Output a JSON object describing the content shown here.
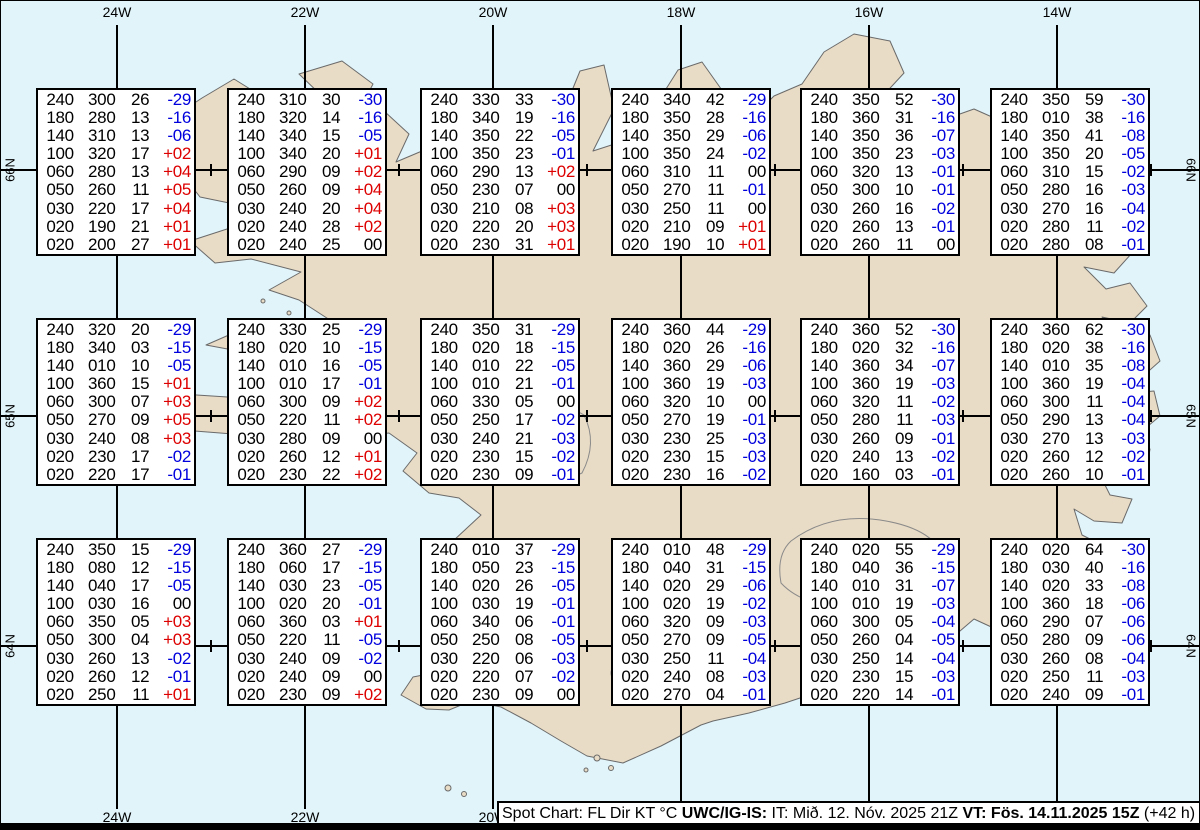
{
  "title": "Spot Chart Iceland UWC/IG-IS",
  "colors": {
    "ocean": "#e1f4fa",
    "land": "#e9dcc6",
    "coastline": "#6a6a6a",
    "grid": "#000000",
    "temp_negative": "#0000dd",
    "temp_positive": "#dd0000",
    "temp_zero": "#000000",
    "box_background": "#ffffff"
  },
  "axis": {
    "top": [
      "24W",
      "22W",
      "20W",
      "18W",
      "16W",
      "14W"
    ],
    "bottom": [
      "24W",
      "22W",
      "20W"
    ],
    "left": [
      "66N",
      "65N",
      "64N"
    ],
    "right": [
      "66N",
      "65N",
      "64N"
    ]
  },
  "caption": {
    "segments": [
      {
        "text": "Spot Chart: FL Dir KT °C ",
        "bold": false
      },
      {
        "text": "UWC/IG-IS:",
        "bold": true
      },
      {
        "text": " IT: Mið. 12. Nóv. 2025 21Z ",
        "bold": false
      },
      {
        "text": "VT: Fös. 14.11.2025 15Z",
        "bold": true
      },
      {
        "text": " (+42 h)",
        "bold": false
      }
    ]
  },
  "chart_data": {
    "type": "table",
    "columns": [
      "FL",
      "Dir",
      "KT",
      "°C"
    ],
    "grid": {
      "rows": 3,
      "cols": 6
    },
    "boxes": [
      {
        "rows": [
          [
            "240",
            "300",
            "26",
            "-29"
          ],
          [
            "180",
            "280",
            "13",
            "-16"
          ],
          [
            "140",
            "310",
            "13",
            "-06"
          ],
          [
            "100",
            "320",
            "17",
            "+02"
          ],
          [
            "060",
            "280",
            "13",
            "+04"
          ],
          [
            "050",
            "260",
            "11",
            "+05"
          ],
          [
            "030",
            "220",
            "17",
            "+04"
          ],
          [
            "020",
            "190",
            "21",
            "+01"
          ],
          [
            "020",
            "200",
            "27",
            "+01"
          ]
        ]
      },
      {
        "rows": [
          [
            "240",
            "310",
            "30",
            "-30"
          ],
          [
            "180",
            "320",
            "14",
            "-16"
          ],
          [
            "140",
            "340",
            "15",
            "-05"
          ],
          [
            "100",
            "340",
            "20",
            "+01"
          ],
          [
            "060",
            "290",
            "09",
            "+02"
          ],
          [
            "050",
            "260",
            "09",
            "+04"
          ],
          [
            "030",
            "240",
            "20",
            "+04"
          ],
          [
            "020",
            "240",
            "28",
            "+02"
          ],
          [
            "020",
            "240",
            "25",
            "00"
          ]
        ]
      },
      {
        "rows": [
          [
            "240",
            "330",
            "33",
            "-30"
          ],
          [
            "180",
            "340",
            "19",
            "-16"
          ],
          [
            "140",
            "350",
            "22",
            "-05"
          ],
          [
            "100",
            "350",
            "23",
            "-01"
          ],
          [
            "060",
            "290",
            "13",
            "+02"
          ],
          [
            "050",
            "230",
            "07",
            "00"
          ],
          [
            "030",
            "210",
            "08",
            "+03"
          ],
          [
            "020",
            "220",
            "20",
            "+03"
          ],
          [
            "020",
            "230",
            "31",
            "+01"
          ]
        ]
      },
      {
        "rows": [
          [
            "240",
            "340",
            "42",
            "-29"
          ],
          [
            "180",
            "350",
            "28",
            "-16"
          ],
          [
            "140",
            "350",
            "29",
            "-06"
          ],
          [
            "100",
            "350",
            "24",
            "-02"
          ],
          [
            "060",
            "310",
            "11",
            "00"
          ],
          [
            "050",
            "270",
            "11",
            "-01"
          ],
          [
            "030",
            "250",
            "11",
            "00"
          ],
          [
            "020",
            "210",
            "09",
            "+01"
          ],
          [
            "020",
            "190",
            "10",
            "+01"
          ]
        ]
      },
      {
        "rows": [
          [
            "240",
            "350",
            "52",
            "-30"
          ],
          [
            "180",
            "360",
            "31",
            "-16"
          ],
          [
            "140",
            "350",
            "36",
            "-07"
          ],
          [
            "100",
            "350",
            "23",
            "-03"
          ],
          [
            "060",
            "320",
            "13",
            "-01"
          ],
          [
            "050",
            "300",
            "10",
            "-01"
          ],
          [
            "030",
            "260",
            "16",
            "-02"
          ],
          [
            "020",
            "260",
            "13",
            "-01"
          ],
          [
            "020",
            "260",
            "11",
            "00"
          ]
        ]
      },
      {
        "rows": [
          [
            "240",
            "350",
            "59",
            "-30"
          ],
          [
            "180",
            "010",
            "38",
            "-16"
          ],
          [
            "140",
            "350",
            "41",
            "-08"
          ],
          [
            "100",
            "350",
            "20",
            "-05"
          ],
          [
            "060",
            "310",
            "15",
            "-02"
          ],
          [
            "050",
            "280",
            "16",
            "-03"
          ],
          [
            "030",
            "270",
            "16",
            "-04"
          ],
          [
            "020",
            "280",
            "11",
            "-02"
          ],
          [
            "020",
            "280",
            "08",
            "-01"
          ]
        ]
      },
      {
        "rows": [
          [
            "240",
            "320",
            "20",
            "-29"
          ],
          [
            "180",
            "340",
            "03",
            "-15"
          ],
          [
            "140",
            "010",
            "10",
            "-05"
          ],
          [
            "100",
            "360",
            "15",
            "+01"
          ],
          [
            "060",
            "300",
            "07",
            "+03"
          ],
          [
            "050",
            "270",
            "09",
            "+05"
          ],
          [
            "030",
            "240",
            "08",
            "+03"
          ],
          [
            "020",
            "230",
            "17",
            "-02"
          ],
          [
            "020",
            "220",
            "17",
            "-01"
          ]
        ]
      },
      {
        "rows": [
          [
            "240",
            "330",
            "25",
            "-29"
          ],
          [
            "180",
            "020",
            "10",
            "-15"
          ],
          [
            "140",
            "010",
            "16",
            "-05"
          ],
          [
            "100",
            "010",
            "17",
            "-01"
          ],
          [
            "060",
            "300",
            "09",
            "+02"
          ],
          [
            "050",
            "220",
            "11",
            "+02"
          ],
          [
            "030",
            "280",
            "09",
            "00"
          ],
          [
            "020",
            "260",
            "12",
            "+01"
          ],
          [
            "020",
            "230",
            "22",
            "+02"
          ]
        ]
      },
      {
        "rows": [
          [
            "240",
            "350",
            "31",
            "-29"
          ],
          [
            "180",
            "020",
            "18",
            "-15"
          ],
          [
            "140",
            "010",
            "22",
            "-05"
          ],
          [
            "100",
            "010",
            "21",
            "-01"
          ],
          [
            "060",
            "330",
            "05",
            "00"
          ],
          [
            "050",
            "250",
            "17",
            "-02"
          ],
          [
            "030",
            "240",
            "21",
            "-03"
          ],
          [
            "020",
            "230",
            "15",
            "-02"
          ],
          [
            "020",
            "230",
            "09",
            "-01"
          ]
        ]
      },
      {
        "rows": [
          [
            "240",
            "360",
            "44",
            "-29"
          ],
          [
            "180",
            "020",
            "26",
            "-16"
          ],
          [
            "140",
            "360",
            "29",
            "-06"
          ],
          [
            "100",
            "360",
            "19",
            "-03"
          ],
          [
            "060",
            "320",
            "10",
            "00"
          ],
          [
            "050",
            "270",
            "19",
            "-01"
          ],
          [
            "030",
            "230",
            "25",
            "-03"
          ],
          [
            "020",
            "230",
            "15",
            "-03"
          ],
          [
            "020",
            "230",
            "16",
            "-02"
          ]
        ]
      },
      {
        "rows": [
          [
            "240",
            "360",
            "52",
            "-30"
          ],
          [
            "180",
            "020",
            "32",
            "-16"
          ],
          [
            "140",
            "360",
            "34",
            "-07"
          ],
          [
            "100",
            "360",
            "19",
            "-03"
          ],
          [
            "060",
            "320",
            "11",
            "-02"
          ],
          [
            "050",
            "280",
            "11",
            "-03"
          ],
          [
            "030",
            "260",
            "09",
            "-01"
          ],
          [
            "020",
            "240",
            "13",
            "-02"
          ],
          [
            "020",
            "160",
            "03",
            "-01"
          ]
        ]
      },
      {
        "rows": [
          [
            "240",
            "360",
            "62",
            "-30"
          ],
          [
            "180",
            "020",
            "38",
            "-16"
          ],
          [
            "140",
            "010",
            "35",
            "-08"
          ],
          [
            "100",
            "360",
            "19",
            "-04"
          ],
          [
            "060",
            "300",
            "11",
            "-04"
          ],
          [
            "050",
            "290",
            "13",
            "-04"
          ],
          [
            "030",
            "270",
            "13",
            "-03"
          ],
          [
            "020",
            "260",
            "12",
            "-02"
          ],
          [
            "020",
            "260",
            "10",
            "-01"
          ]
        ]
      },
      {
        "rows": [
          [
            "240",
            "350",
            "15",
            "-29"
          ],
          [
            "180",
            "080",
            "12",
            "-15"
          ],
          [
            "140",
            "040",
            "17",
            "-05"
          ],
          [
            "100",
            "030",
            "16",
            "00"
          ],
          [
            "060",
            "350",
            "05",
            "+03"
          ],
          [
            "050",
            "300",
            "04",
            "+03"
          ],
          [
            "030",
            "260",
            "13",
            "-02"
          ],
          [
            "020",
            "260",
            "12",
            "-01"
          ],
          [
            "020",
            "250",
            "11",
            "+01"
          ]
        ]
      },
      {
        "rows": [
          [
            "240",
            "360",
            "27",
            "-29"
          ],
          [
            "180",
            "060",
            "17",
            "-15"
          ],
          [
            "140",
            "030",
            "23",
            "-05"
          ],
          [
            "100",
            "020",
            "20",
            "-01"
          ],
          [
            "060",
            "360",
            "03",
            "+01"
          ],
          [
            "050",
            "220",
            "11",
            "-05"
          ],
          [
            "030",
            "240",
            "09",
            "-02"
          ],
          [
            "020",
            "240",
            "09",
            "00"
          ],
          [
            "020",
            "230",
            "09",
            "+02"
          ]
        ]
      },
      {
        "rows": [
          [
            "240",
            "010",
            "37",
            "-29"
          ],
          [
            "180",
            "050",
            "23",
            "-15"
          ],
          [
            "140",
            "020",
            "26",
            "-05"
          ],
          [
            "100",
            "030",
            "19",
            "-01"
          ],
          [
            "060",
            "340",
            "06",
            "-01"
          ],
          [
            "050",
            "250",
            "08",
            "-05"
          ],
          [
            "030",
            "220",
            "06",
            "-03"
          ],
          [
            "020",
            "220",
            "07",
            "-02"
          ],
          [
            "020",
            "230",
            "09",
            "00"
          ]
        ]
      },
      {
        "rows": [
          [
            "240",
            "010",
            "48",
            "-29"
          ],
          [
            "180",
            "040",
            "31",
            "-15"
          ],
          [
            "140",
            "020",
            "29",
            "-06"
          ],
          [
            "100",
            "020",
            "19",
            "-02"
          ],
          [
            "060",
            "320",
            "09",
            "-03"
          ],
          [
            "050",
            "270",
            "09",
            "-05"
          ],
          [
            "030",
            "250",
            "11",
            "-04"
          ],
          [
            "020",
            "240",
            "08",
            "-03"
          ],
          [
            "020",
            "270",
            "04",
            "-01"
          ]
        ]
      },
      {
        "rows": [
          [
            "240",
            "020",
            "55",
            "-29"
          ],
          [
            "180",
            "040",
            "36",
            "-15"
          ],
          [
            "140",
            "010",
            "31",
            "-07"
          ],
          [
            "100",
            "010",
            "19",
            "-03"
          ],
          [
            "060",
            "300",
            "05",
            "-04"
          ],
          [
            "050",
            "260",
            "04",
            "-05"
          ],
          [
            "030",
            "250",
            "14",
            "-04"
          ],
          [
            "020",
            "230",
            "15",
            "-03"
          ],
          [
            "020",
            "220",
            "14",
            "-01"
          ]
        ]
      },
      {
        "rows": [
          [
            "240",
            "020",
            "64",
            "-30"
          ],
          [
            "180",
            "030",
            "40",
            "-16"
          ],
          [
            "140",
            "020",
            "33",
            "-08"
          ],
          [
            "100",
            "360",
            "18",
            "-06"
          ],
          [
            "060",
            "290",
            "07",
            "-06"
          ],
          [
            "050",
            "280",
            "09",
            "-06"
          ],
          [
            "030",
            "260",
            "08",
            "-04"
          ],
          [
            "020",
            "250",
            "11",
            "-03"
          ],
          [
            "020",
            "240",
            "09",
            "-01"
          ]
        ]
      }
    ]
  }
}
